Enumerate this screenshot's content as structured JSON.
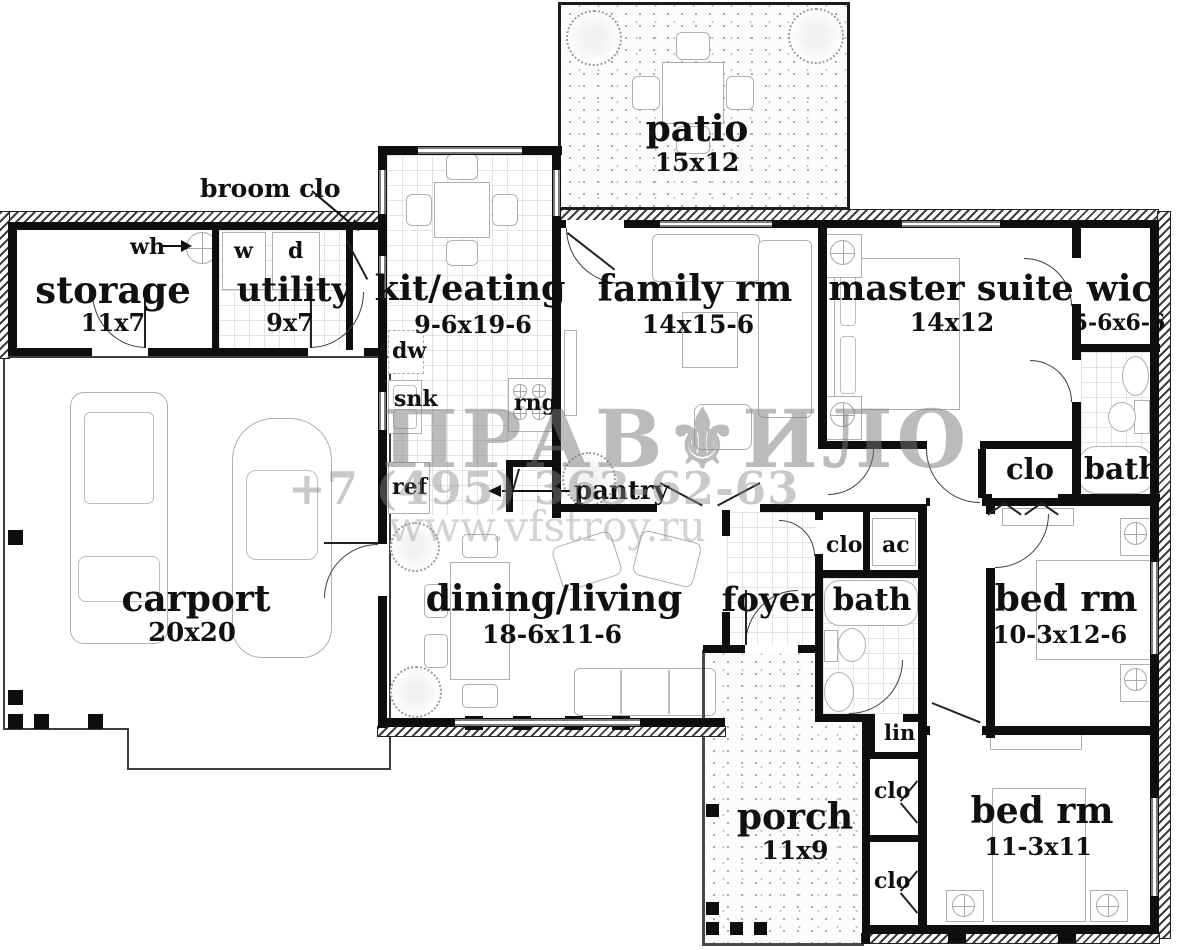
{
  "watermark": {
    "brand": "ПРАВ⚜ИЛО",
    "phone": "+7 (495) 363-62-63",
    "url": "www.vfstroy.ru"
  },
  "rooms": {
    "patio": {
      "name": "patio",
      "dims": "15x12"
    },
    "storage": {
      "name": "storage",
      "dims": "11x7"
    },
    "utility": {
      "name": "utility",
      "dims": "9x7"
    },
    "kit_eating": {
      "name": "kit/eating",
      "dims": "9-6x19-6"
    },
    "family_rm": {
      "name": "family rm",
      "dims": "14x15-6"
    },
    "master_suite": {
      "name": "master suite",
      "dims": "14x12"
    },
    "wic": {
      "name": "wic",
      "dims": "5-6x6-6"
    },
    "carport": {
      "name": "carport",
      "dims": "20x20"
    },
    "dining_living": {
      "name": "dining/living",
      "dims": "18-6x11-6"
    },
    "foyer": {
      "name": "foyer"
    },
    "bath_mid": {
      "name": "bath"
    },
    "bath_master": {
      "name": "bath"
    },
    "bed_rm_right": {
      "name": "bed rm",
      "dims": "10-3x12-6"
    },
    "bed_rm_bottom": {
      "name": "bed rm",
      "dims": "11-3x11"
    },
    "porch": {
      "name": "porch",
      "dims": "11x9"
    }
  },
  "callouts": {
    "broom_clo": "broom clo",
    "wh": "wh",
    "washer": "w",
    "dryer": "d",
    "dw": "dw",
    "snk": "snk",
    "rng": "rng",
    "ref": "ref",
    "pantry": "pantry",
    "clo_master": "clo",
    "clo_foyer": "clo",
    "ac": "ac",
    "lin": "lin",
    "clo_hall_upper": "clo",
    "clo_hall_lower": "clo"
  }
}
